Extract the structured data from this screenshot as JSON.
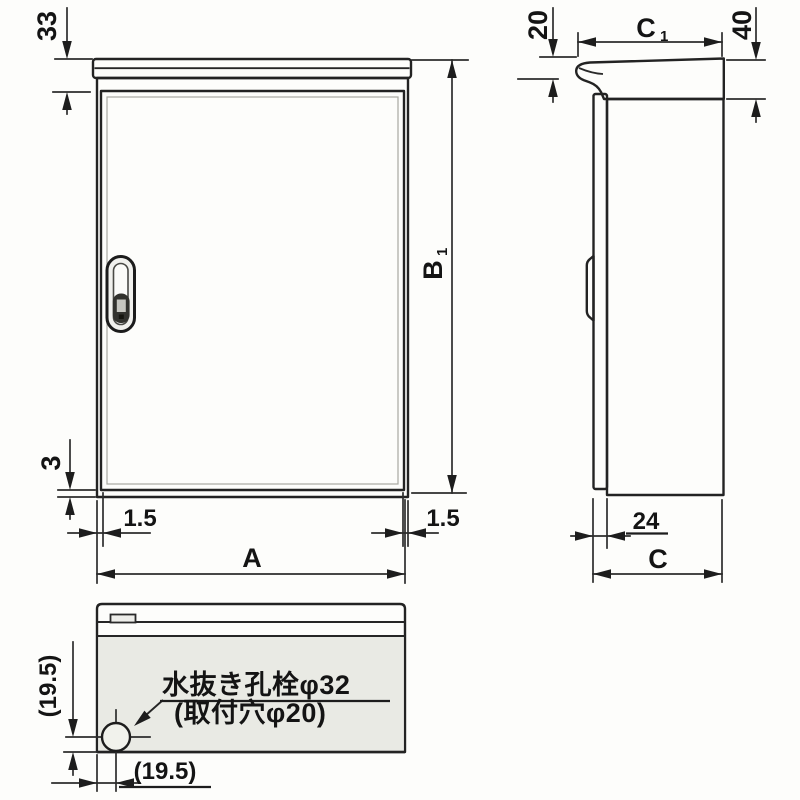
{
  "front_view": {
    "roof_offset": "33",
    "bottom_gap": "3",
    "left_door_inset": "1.5",
    "right_door_inset": "1.5",
    "width_label": "A",
    "height_label": {
      "main": "B",
      "sub": "1"
    }
  },
  "side_view": {
    "roof_front_drop": "20",
    "roof_depth_label": {
      "main": "C",
      "sub": "1"
    },
    "roof_edge_height": "40",
    "door_protrusion": "24",
    "depth_label": "C"
  },
  "bottom_view": {
    "drain_note_line1": "水抜き孔栓φ32",
    "drain_note_line2": "(取付穴φ20)",
    "drain_offset_vertical": "(19.5)",
    "drain_offset_horizontal": "(19.5)"
  },
  "colors": {
    "line": "#2b2b2b",
    "panel_fill": "#e9eae4",
    "background": "#fdfdfb"
  }
}
